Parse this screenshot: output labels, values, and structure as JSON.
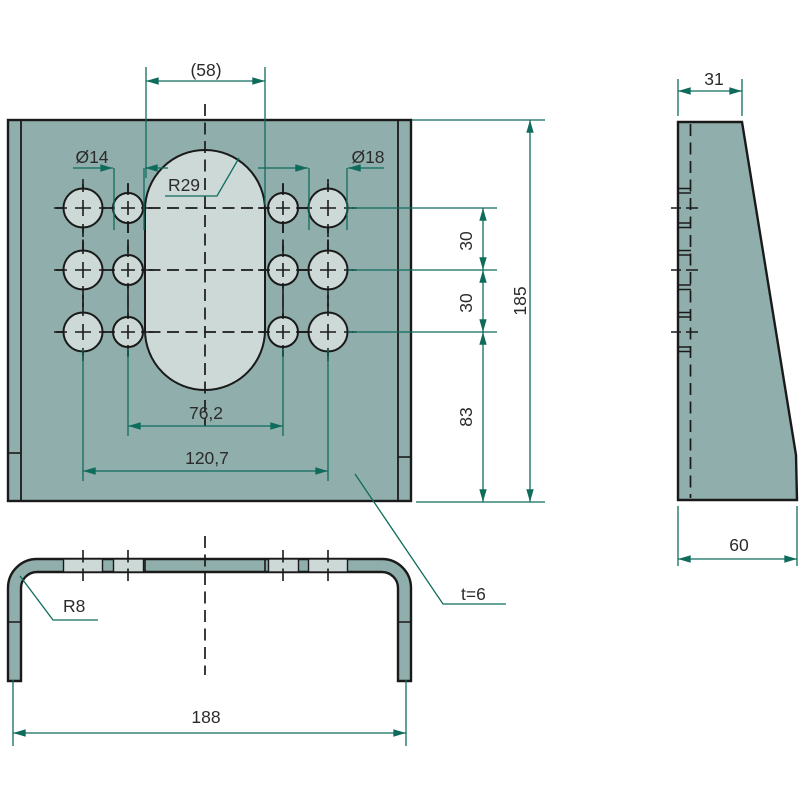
{
  "colors": {
    "plate": "#90aeab",
    "hole_fill": "#cdd9d6",
    "outline": "#1a1a1a",
    "dim": "#0f6c5d",
    "text": "#2b2b2b",
    "background": "#ffffff"
  },
  "front_view": {
    "dims": {
      "slot_width": "(58)",
      "dia_small": "Ø14",
      "dia_large": "Ø18",
      "slot_radius": "R29",
      "inner_hole_span": "76,2",
      "outer_hole_span": "120,7",
      "row_spacing_top": "30",
      "row_spacing_bottom": "30",
      "bottom_offset": "83",
      "total_height": "185",
      "thickness": "t=6"
    }
  },
  "side_view": {
    "dims": {
      "top_width": "31",
      "bottom_width": "60"
    }
  },
  "bottom_view": {
    "dims": {
      "corner_radius": "R8",
      "total_width": "188"
    }
  }
}
